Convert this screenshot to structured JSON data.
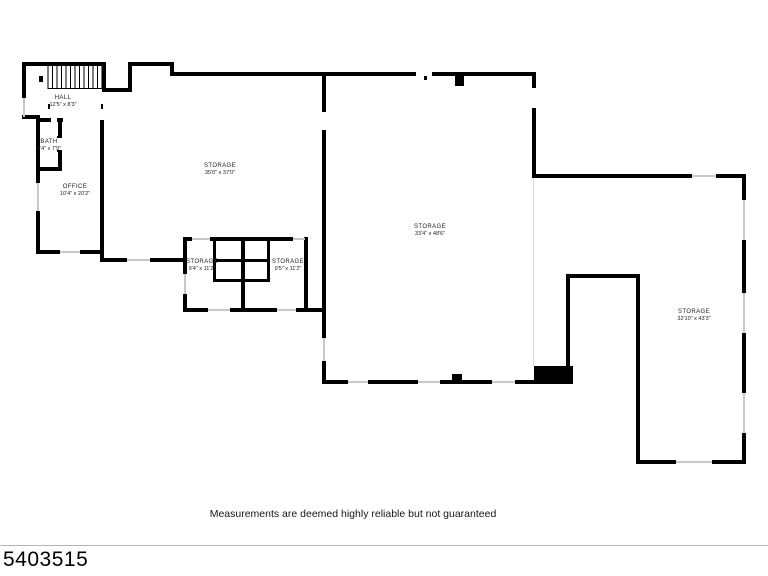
{
  "plan": {
    "rooms": [
      {
        "name": "HALL",
        "dims": "12'5\" x 8'3\""
      },
      {
        "name": "BATH",
        "dims": "7'4\" x 7'9\""
      },
      {
        "name": "OFFICE",
        "dims": "10'4\" x 20'2\""
      },
      {
        "name": "STORAGE",
        "dims": "35'0\" x 37'0\""
      },
      {
        "name": "STORAGE",
        "dims": "33'4\" x 48'6\""
      },
      {
        "name": "STORAGE",
        "dims": "32'10\" x 43'3\""
      },
      {
        "name": "STORAGE",
        "dims": "9'4\" x 11'2\""
      },
      {
        "name": "STORAGE",
        "dims": "9'5\" x 11'2\""
      }
    ],
    "disclaimer": "Measurements are deemed highly reliable but not guaranteed",
    "listing_id": "5403515",
    "colors": {
      "wall": "#000000",
      "window": "#c9c9c9",
      "background": "#ffffff"
    }
  }
}
